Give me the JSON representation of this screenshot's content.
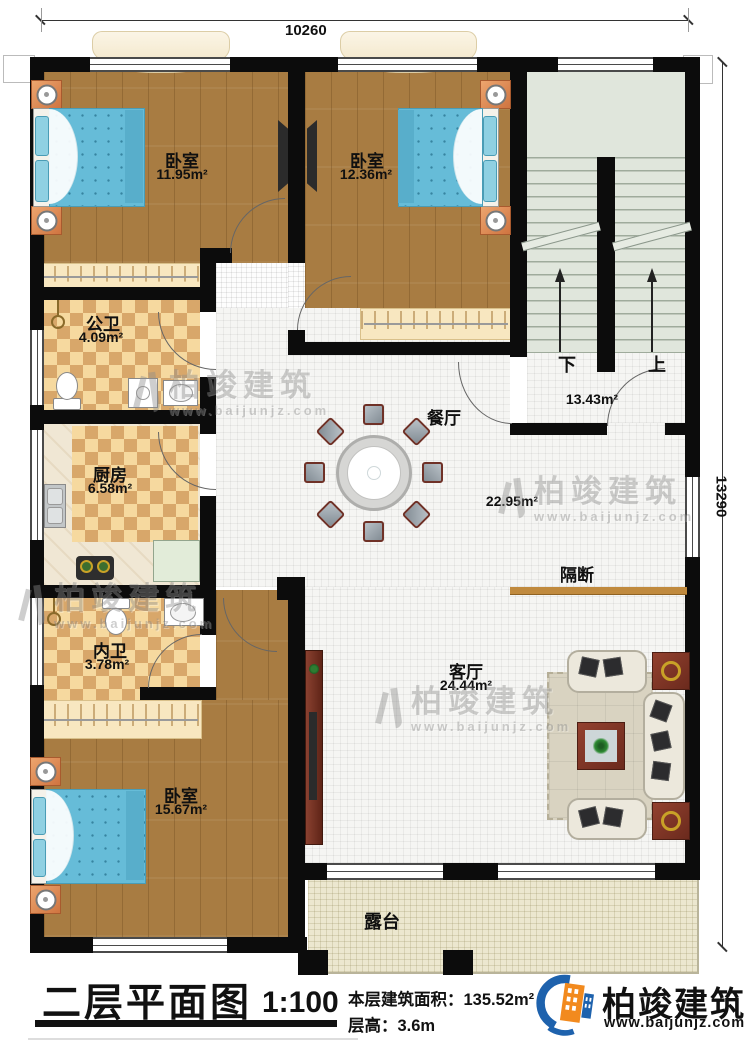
{
  "plan": {
    "dim_top": "10260",
    "dim_right": "13290",
    "rooms": [
      {
        "name": "卧室",
        "area": "11.95m²"
      },
      {
        "name": "卧室",
        "area": "12.36m²"
      },
      {
        "name": "公卫",
        "area": "4.09m²"
      },
      {
        "name": "厨房",
        "area": "6.58m²"
      },
      {
        "name": "内卫",
        "area": "3.78m²"
      },
      {
        "name": "卧室",
        "area": "15.67m²"
      },
      {
        "name": "餐厅",
        "area": "22.95m²"
      },
      {
        "name": "客厅",
        "area": "24.44m²"
      }
    ],
    "stairs": {
      "down": "下",
      "up": "上",
      "area": "13.43m²"
    },
    "partition_label": "隔断",
    "terrace_label": "露台"
  },
  "watermark": {
    "brand": "柏竣建筑",
    "url": "www.baijunjz.com"
  },
  "footer": {
    "title": "二层平面图",
    "scale": "1:100",
    "floor_area_label": "本层建筑面积：",
    "floor_area_value": "135.52m²",
    "floor_height_label": "层高：",
    "floor_height_value": "3.6m",
    "brand": "柏竣建筑",
    "brand_url": "www.baijunjz.com"
  }
}
